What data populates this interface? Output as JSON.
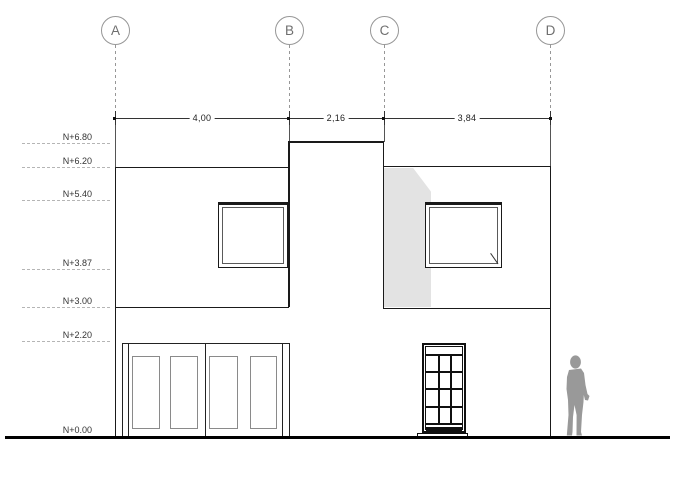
{
  "drawing": {
    "kind": "building elevation",
    "ground_label": "N+0.00"
  },
  "grid_axes": [
    {
      "letter": "A"
    },
    {
      "letter": "B"
    },
    {
      "letter": "C"
    },
    {
      "letter": "D"
    }
  ],
  "dimensions": [
    {
      "value": "4,00",
      "between": "A-B"
    },
    {
      "value": "2,16",
      "between": "B-C"
    },
    {
      "value": "3,84",
      "between": "C-D"
    }
  ],
  "levels": [
    {
      "label": "N+6.80",
      "value": 6.8
    },
    {
      "label": "N+6.20",
      "value": 6.2
    },
    {
      "label": "N+5.40",
      "value": 5.4
    },
    {
      "label": "N+3.87",
      "value": 3.87
    },
    {
      "label": "N+3.00",
      "value": 3.0
    },
    {
      "label": "N+2.20",
      "value": 2.2
    },
    {
      "label": "N+0.00",
      "value": 0.0
    }
  ],
  "colors": {
    "background": "#ffffff",
    "line": "#1a1a1a",
    "grid": "#979797",
    "level": "#b5b5b5",
    "text": "#333333",
    "shadow": "#e3e3e3",
    "figure": "#999999"
  }
}
